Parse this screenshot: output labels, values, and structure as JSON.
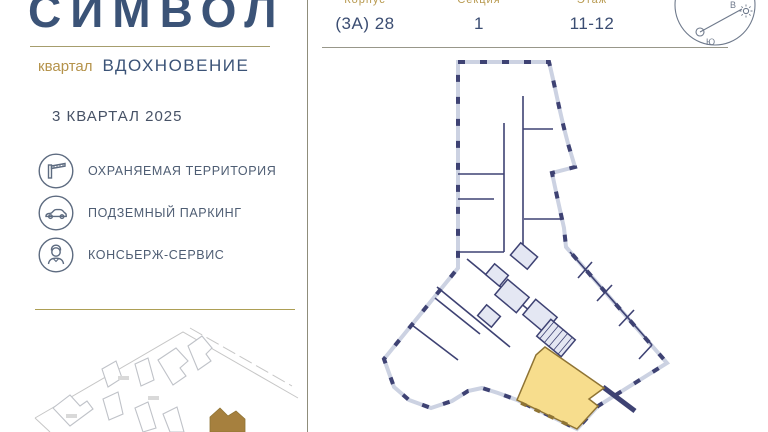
{
  "brand": {
    "title": "СИМВОЛ",
    "quarter_label": "квартал",
    "quarter_name": "ВДОХНОВЕНИЕ",
    "delivery": "3 КВАРТАЛ 2025"
  },
  "unit_header": {
    "columns": [
      {
        "label": "Корпус",
        "value": "(3А) 28"
      },
      {
        "label": "Секция",
        "value": "1"
      },
      {
        "label": "Этаж",
        "value": "11-12"
      }
    ]
  },
  "features": {
    "items": [
      {
        "icon": "barrier-icon",
        "label": "ОХРАНЯЕМАЯ ТЕРРИТОРИЯ"
      },
      {
        "icon": "car-icon",
        "label": "ПОДЗЕМНЫЙ ПАРКИНГ"
      },
      {
        "icon": "concierge-icon",
        "label": "КОНСЬЕРЖ-СЕРВИС"
      }
    ]
  },
  "compass": {
    "south": "Ю",
    "east": "В"
  },
  "colors": {
    "brand_navy": "#3b5377",
    "brand_gold": "#b5934b",
    "plan_wall_navy": "#3e4273",
    "plan_wall_light": "#ccd2e2",
    "highlight_fill": "#f7dd8d",
    "highlight_stroke": "#8f7434",
    "map_marker_gold": "#a6803e"
  }
}
